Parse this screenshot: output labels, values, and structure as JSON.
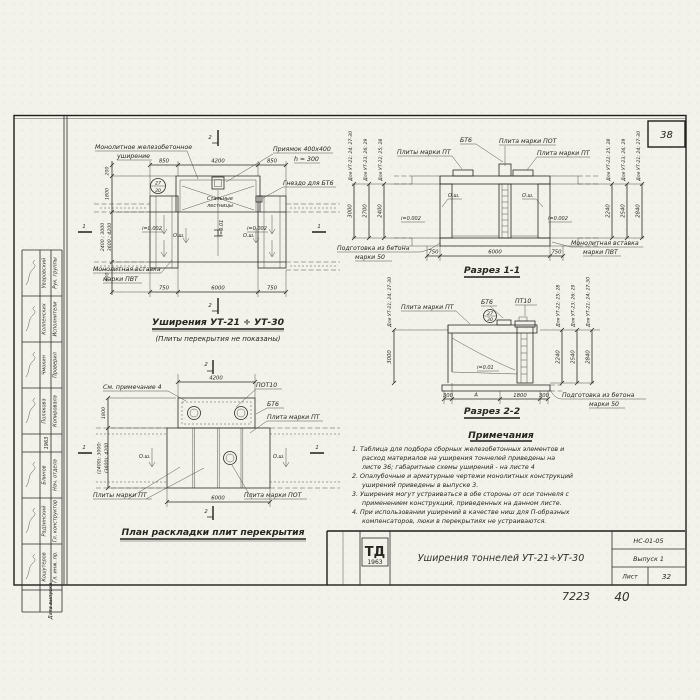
{
  "page": {
    "corner_sheet_number": "38",
    "handwritten_code": "7223",
    "handwritten_sheet": "40"
  },
  "stamp": {
    "year": "1963",
    "rows": [
      {
        "role": "Рук. группы",
        "name": "Уваровский"
      },
      {
        "role": "Исполнители",
        "name": "Колпенских"
      },
      {
        "role": "Проверил",
        "name": "Чмокин"
      },
      {
        "role": "Копировала",
        "name": "Полякова"
      },
      {
        "role": "Нач. отдела",
        "name": "Блинов"
      },
      {
        "role": "Гл. конструктор",
        "name": "Радзинский"
      },
      {
        "role": "Гл. инж. пр.",
        "name": "Кошутеров"
      },
      {
        "role": "Дата выпуска",
        "name": ""
      }
    ]
  },
  "drawing1": {
    "title": "Уширения УТ-21 ÷ УТ-30",
    "subtitle": "(Плиты перекрытия не показаны)",
    "labels": {
      "monolithic1": "Монолитное железобетонное",
      "monolithic2": "уширение",
      "pit1": "Приямок 400x400",
      "pit2": "h = 300",
      "socket": "Гнездо для БТ6",
      "stairs1": "Стальные",
      "stairs2": "лестницы",
      "insert1": "Монолитная вставка",
      "insert2": "марки ПВТ",
      "slope_left": "i=0.002",
      "slope_right": "i=0.002",
      "slope_center": "i=0.01",
      "axis_left": "О.ш.",
      "axis_right": "О.ш."
    },
    "dims": {
      "top": [
        "850",
        "4200",
        "850"
      ],
      "bottom": [
        "750",
        "6000",
        "750"
      ],
      "left": [
        "200",
        "1800",
        "2400 ; 3000",
        "3600 ; 4200",
        "600"
      ]
    },
    "marks": {
      "top": "2",
      "bottom": "2",
      "left": "1",
      "right": "1"
    },
    "detail": {
      "top": "27",
      "bottom": "30"
    }
  },
  "drawing2": {
    "title": "Разрез 1-1",
    "labels": {
      "plates_pt": "Плиты марки ПТ",
      "bt6": "БТ6",
      "plate_pot": "Плита марки ПОТ",
      "plate_pt": "Плита марки ПТ",
      "insert1": "Монолитная вставка",
      "insert2": "марки ПВТ",
      "prep1": "Подготовка из бетона",
      "prep2": "марки 50",
      "axis_left": "О.ш.",
      "axis_right": "О.ш.",
      "slope_left": "i=0.002",
      "slope_right": "i=0.002"
    },
    "dims": {
      "bottom": [
        "750",
        "6000",
        "750"
      ]
    },
    "chains_left": [
      {
        "label": "Для УТ-21; 24; 27-30",
        "value": "3000"
      },
      {
        "label": "Для УТ-23; 26; 29",
        "value": "2700"
      },
      {
        "label": "Для УТ-22; 25; 28",
        "value": "2400"
      }
    ],
    "chains_right": [
      {
        "label": "Для УТ-22; 25; 28",
        "value": "2240"
      },
      {
        "label": "Для УТ-23; 26; 29",
        "value": "2540"
      },
      {
        "label": "Для УТ-21; 24; 27-30",
        "value": "2840"
      }
    ]
  },
  "drawing3": {
    "title": "Разрез 2-2",
    "labels": {
      "plate_pt": "Плита марки ПТ",
      "bt6": "БТ6",
      "pt10": "ПТ10",
      "slope": "i=0.01",
      "prep1": "Подготовка из бетона",
      "prep2": "марки 50"
    },
    "dims": {
      "bottom": [
        "300",
        "А",
        "1800",
        "300"
      ]
    },
    "chain_left": {
      "label": "Для УТ-21; 24; 27-30",
      "value": "3000"
    },
    "chains_right": [
      {
        "label": "Для УТ-22; 25; 28",
        "value": "2240"
      },
      {
        "label": "Для УТ-23; 26; 29",
        "value": "2540"
      },
      {
        "label": "Для УТ-21; 24; 27-30",
        "value": "2840"
      }
    ],
    "detail": {
      "top": "27",
      "bottom": "30"
    }
  },
  "drawing4": {
    "title": "План раскладки плит перекрытия",
    "labels": {
      "see_note": "См. примечание 4",
      "pot10": "ПОТ10",
      "bt6": "БТ6",
      "plate_pt": "Плита марки ПТ",
      "plates_pt": "Плиты марки ПТ",
      "plate_pot": "Плита марки ПОТ",
      "axis_left": "О.ш.",
      "axis_right": "О.ш."
    },
    "dims": {
      "top": "4200",
      "bottom": "6000",
      "left_depth": "1800",
      "left_heights1": "(2400); 3000;",
      "left_heights2": "(3600); 4200"
    },
    "marks": {
      "top": "2",
      "bottom": "2",
      "left": "1",
      "right": "1"
    }
  },
  "notes": {
    "header": "Примечания",
    "lines": [
      "1. Таблица для подбора сборных железобетонных элементов и",
      "расход материалов на уширения тоннелей приведены на",
      "листе 36; габаритные схемы уширений - на листе 4",
      "2. Опалубочные и арматурные чертежи монолитных конструкций",
      "уширений приведены в выпуске 3.",
      "3. Уширения могут устраиваться в обе стороны от оси тоннеля с",
      "применением конструкций, приведенных на данном листе.",
      "4. При использовании уширений в качестве ниш для П-образных",
      "компенсаторов, люки в перекрытиях не устраиваются."
    ]
  },
  "titleblock": {
    "logo_top": "ТД",
    "logo_year": "1963",
    "title": "Уширения тоннелей УТ-21÷УТ-30",
    "code": "НС-01-05",
    "issue": "Выпуск 1",
    "sheet_label": "Лист",
    "sheet_number": "32"
  }
}
